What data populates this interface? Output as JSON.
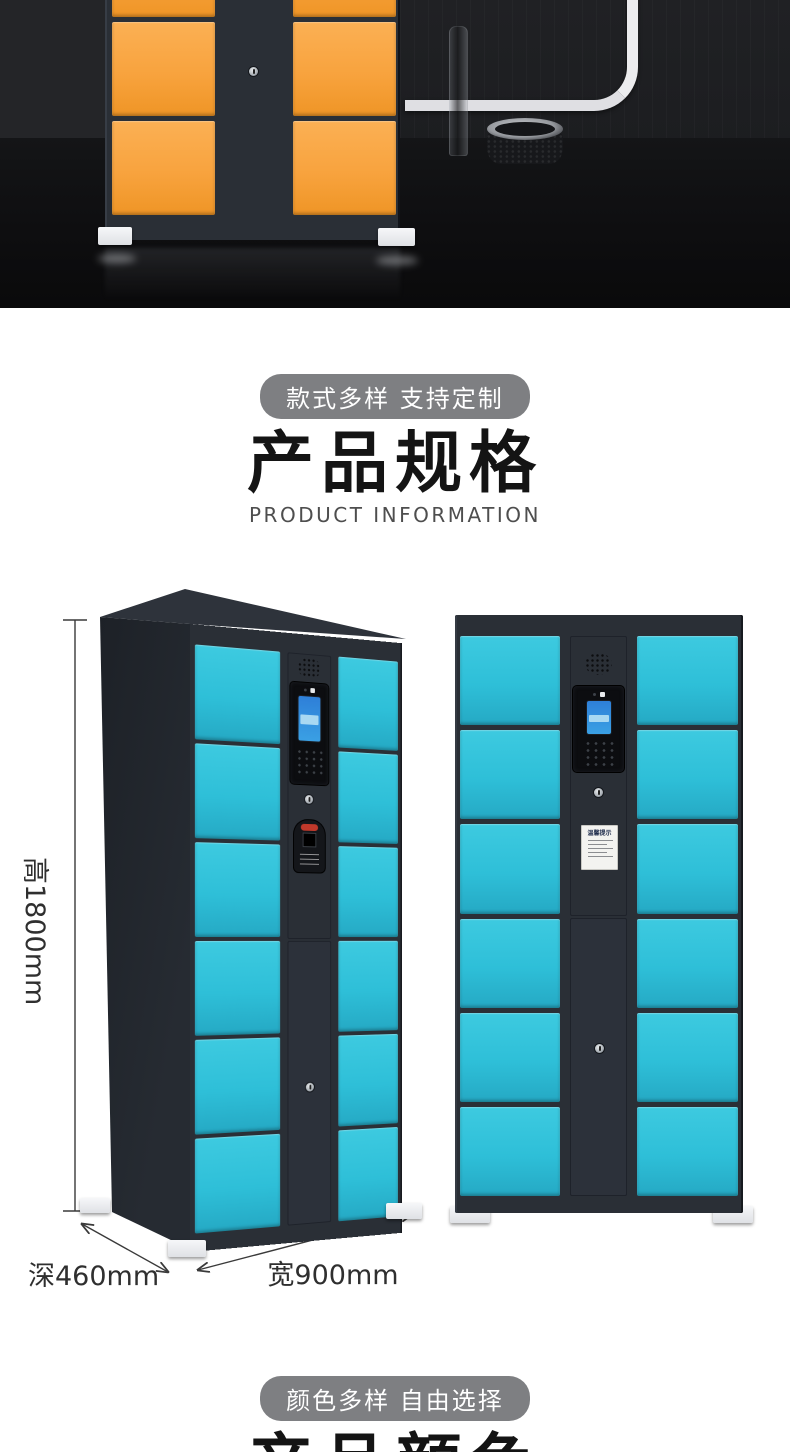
{
  "specs": {
    "badge": "款式多样 支持定制",
    "title": "产品规格",
    "subtitle": "PRODUCT INFORMATION",
    "dimensions": {
      "height": "高1800mm",
      "depth": "深460mm",
      "width": "宽900mm"
    },
    "sticker_title": "温馨提示"
  },
  "colors_section": {
    "badge": "颜色多样 自由选择",
    "title": "产品颜色"
  },
  "colors": {
    "door-blue": "#2EBFD8",
    "door-blue-light": "#3DCAE0",
    "door-blue-deep": "#25A9C4",
    "door-orange": "#F8A33E",
    "door-orange-light": "#FBB054",
    "door-orange-deep": "#EF9526",
    "frame": "#2A2F36",
    "badge-bg": "#7E7F82"
  },
  "icons": {
    "speaker": "speaker-grille-icon",
    "screen": "touch-screen",
    "keypad": "keypad-icon",
    "keyhole": "keyhole-icon",
    "scanner": "qr-scanner-icon",
    "camera": "camera-icon"
  }
}
